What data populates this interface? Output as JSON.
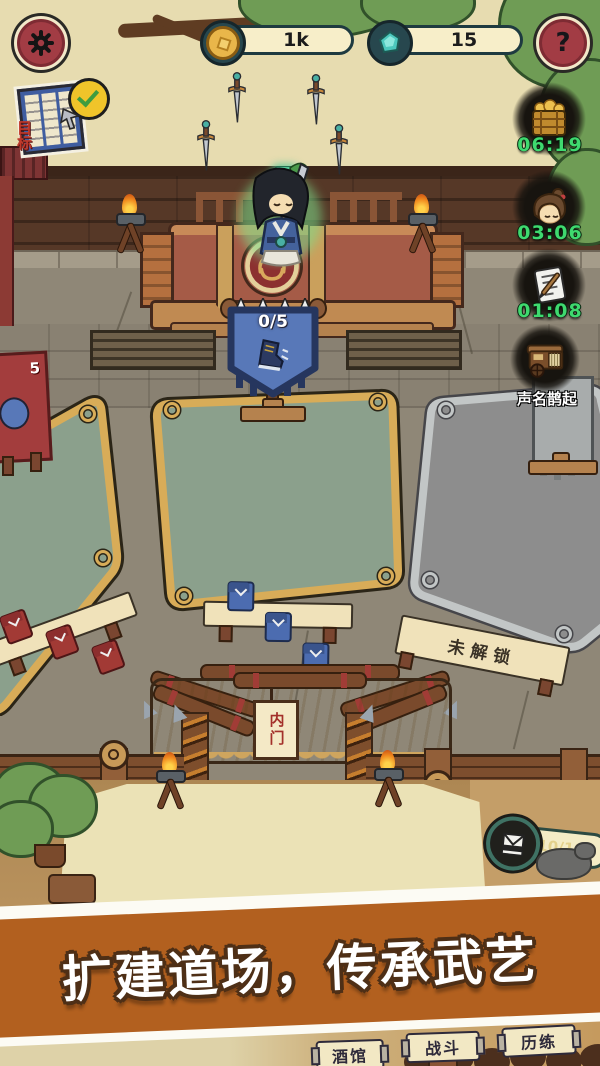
{
  "colors": {
    "hud_button_red": "#a23c44",
    "timer_green": "#3fd96f",
    "coin_gold": "#e9b64a",
    "gem_teal": "#4cc8bd",
    "mat_green": "#8ba08c",
    "mat_gold_border": "#d8ac58",
    "quest_banner_blue": "#5878b8",
    "promo_orange": "#b2601f"
  },
  "icons": {
    "settings": "gear-icon",
    "help": "question-icon",
    "goal": "map-icon-with-checkmark",
    "timer_1": "treasure-chest-icon",
    "timer_2": "disciple-head-icon",
    "timer_3": "scroll-brush-icon",
    "caravan": "caravan-cart-icon",
    "uniform": "training-gi-icon",
    "quest": "boot-icon"
  },
  "hud": {
    "coin_value": "1k",
    "gem_value": "15",
    "help_label": "?",
    "goal_label": "目标",
    "timers": [
      {
        "name": "chest-reward",
        "time": "06:19"
      },
      {
        "name": "disciple-rest",
        "time": "03:06"
      },
      {
        "name": "scroll-task",
        "time": "01:08"
      }
    ],
    "caravan_label": "声名鹊起",
    "uniform_count": "10/10"
  },
  "scene": {
    "quest_progress": "0/5",
    "left_banner_count": "5",
    "locked_label": "未解锁",
    "gate_label": "内门"
  },
  "promo": {
    "banner_text": "扩建道场，传承武艺"
  },
  "nav": {
    "tavern": "酒馆",
    "battle": "战斗",
    "training": "历练"
  }
}
